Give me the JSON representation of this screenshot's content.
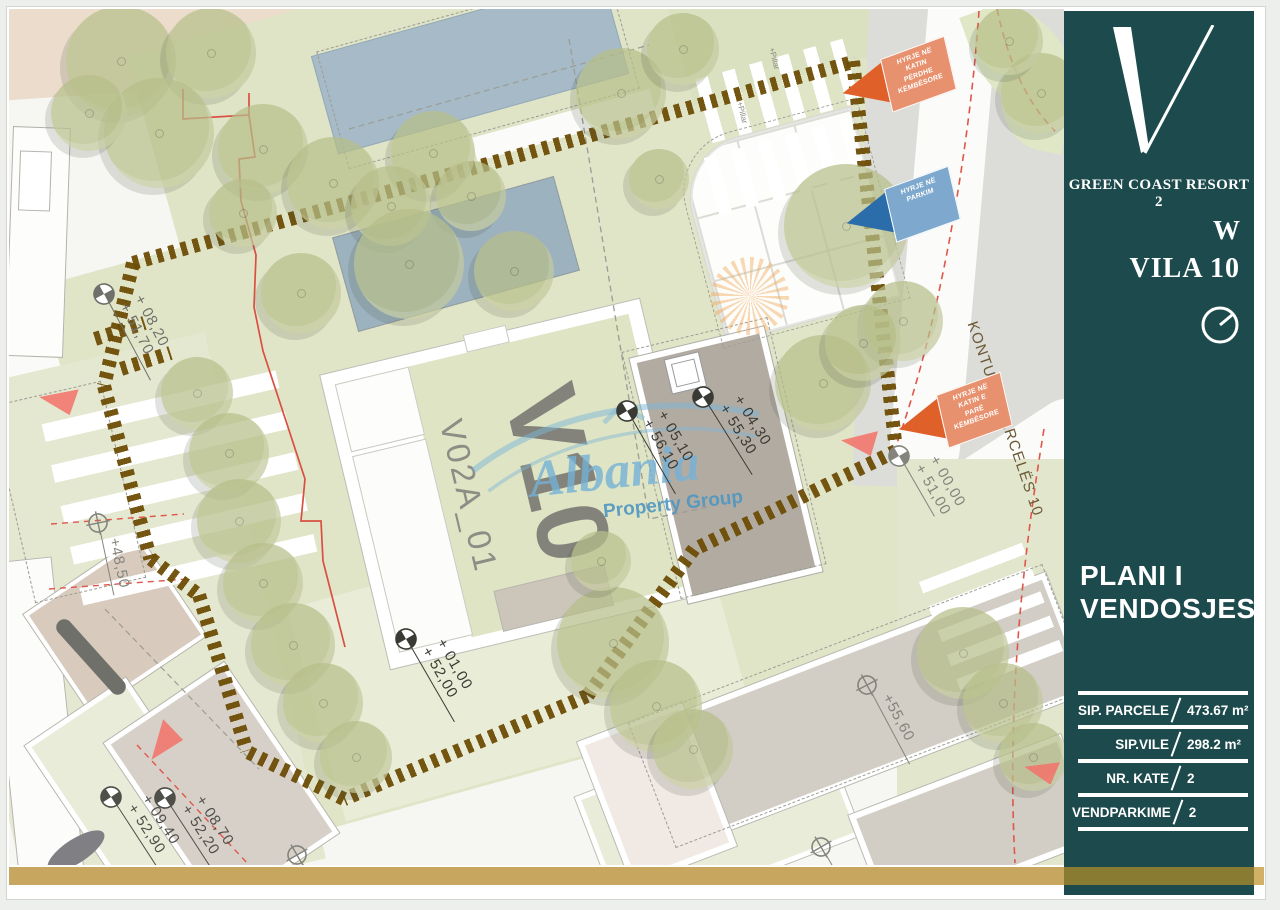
{
  "sidebar": {
    "brand": "GREEN COAST RESORT 2",
    "unit_letter": "W",
    "unit_name": "VILA 10",
    "plan_title_line1": "PLANI I",
    "plan_title_line2": "VENDOSJES",
    "table": [
      {
        "label": "SIP. PARCELE",
        "value": "473.67 m²"
      },
      {
        "label": "SIP.VILE",
        "value": "298.2  m²"
      },
      {
        "label": "NR. KATE",
        "value": "2"
      },
      {
        "label": "VENDPARKIME",
        "value": "2"
      }
    ]
  },
  "plan": {
    "villa_big_label": "V10",
    "villa_code": "V02A_01",
    "street_label": "KONTURI I PARCELËS 10",
    "pillar_label": "+Pillar",
    "watermark": {
      "line1": "Albania",
      "line2": "Property Group"
    }
  },
  "colors": {
    "sidebar_teal": "#1d4a4c",
    "gold": "#c7a65f",
    "gold_dark": "#8a7b33",
    "hatch_brown": "#6d4d06",
    "flag_orange_arrow": "#e0602a",
    "flag_orange_body": "#e8916f",
    "flag_blue_arrow": "#2b6cab",
    "flag_blue_body": "#7ea8cd",
    "red_triangle": "#f3746b",
    "watermark_blue": "#74b2d8",
    "lawn_green": "#e1e5c8",
    "pool_blue": "#a6bbc7"
  },
  "markers": [
    {
      "x": 95,
      "y": 285,
      "rot": 62,
      "type": "quad",
      "len": 88,
      "color": "#70706a",
      "lines": [
        "+ 08,20",
        "+ 51,70"
      ]
    },
    {
      "x": 89,
      "y": 514,
      "rot": 78,
      "type": "cross",
      "len": 64,
      "color": "#84847d",
      "lines": [
        "+48,50"
      ]
    },
    {
      "x": 397,
      "y": 630,
      "rot": 60,
      "type": "quad",
      "len": 86,
      "color": "#3a3a34",
      "lines": [
        "+ 01,00",
        "+ 52,00"
      ]
    },
    {
      "x": 618,
      "y": 402,
      "rot": 60,
      "type": "quad",
      "len": 86,
      "color": "#3a3a34",
      "lines": [
        "+ 05,10",
        "+ 56,10"
      ]
    },
    {
      "x": 694,
      "y": 388,
      "rot": 58,
      "type": "quad",
      "len": 82,
      "color": "#3a3a34",
      "lines": [
        "+ 04,30",
        "+ 55,30"
      ]
    },
    {
      "x": 890,
      "y": 447,
      "rot": 60,
      "type": "quad",
      "len": 60,
      "color": "#84847d",
      "lines": [
        "+ 00,00",
        "+ 51,00"
      ]
    },
    {
      "x": 858,
      "y": 676,
      "rot": 62,
      "type": "cross",
      "len": 80,
      "color": "#84847d",
      "lines": [
        "+55,60"
      ]
    },
    {
      "x": 102,
      "y": 788,
      "rot": 57,
      "type": "quad",
      "len": 85,
      "color": "#4f4f49",
      "lines": [
        "+ 09,40",
        "+ 52,90"
      ]
    },
    {
      "x": 156,
      "y": 789,
      "rot": 57,
      "type": "quad",
      "len": 85,
      "color": "#4f4f49",
      "lines": [
        "+ 08,70",
        "+ 52,20"
      ]
    },
    {
      "x": 288,
      "y": 846,
      "rot": 60,
      "type": "cross",
      "len": 26,
      "color": "#84847d",
      "lines": []
    },
    {
      "x": 812,
      "y": 838,
      "rot": 60,
      "type": "cross",
      "len": 26,
      "color": "#84847d",
      "lines": []
    }
  ],
  "flags": [
    {
      "x": 832,
      "y": 42,
      "rot": -13,
      "arrow": "#e0602a",
      "body": "#e8916f",
      "lines": [
        "HYRJE NË",
        "KATIN",
        "PËRDHE",
        "KËMBËSORE"
      ]
    },
    {
      "x": 836,
      "y": 172,
      "rot": -13,
      "arrow": "#2b6cab",
      "body": "#7ea8cd",
      "lines": [
        "HYRJE NË",
        "PARKIM"
      ]
    },
    {
      "x": 888,
      "y": 378,
      "rot": -13,
      "arrow": "#e0602a",
      "body": "#e8916f",
      "lines": [
        "HYRJE NË",
        "KATIN  E",
        "PARË",
        "KËMBËSORE"
      ]
    }
  ],
  "triangles": [
    {
      "x": 30,
      "y": 377,
      "rot": 8,
      "size": 38
    },
    {
      "x": 832,
      "y": 420,
      "rot": 5,
      "size": 36
    },
    {
      "x": 1015,
      "y": 749,
      "rot": 12,
      "size": 34
    },
    {
      "x": 134,
      "y": 720,
      "rot": -55,
      "size": 40
    }
  ],
  "trees": [
    [
      112,
      52,
      55
    ],
    [
      202,
      44,
      45
    ],
    [
      150,
      124,
      55
    ],
    [
      80,
      104,
      38
    ],
    [
      254,
      140,
      45
    ],
    [
      324,
      174,
      46
    ],
    [
      292,
      284,
      40
    ],
    [
      234,
      204,
      34
    ],
    [
      424,
      144,
      42
    ],
    [
      612,
      84,
      45
    ],
    [
      674,
      40,
      36
    ],
    [
      837,
      217,
      62
    ],
    [
      894,
      312,
      40
    ],
    [
      650,
      170,
      30
    ],
    [
      188,
      384,
      36
    ],
    [
      220,
      444,
      40
    ],
    [
      230,
      512,
      42
    ],
    [
      254,
      574,
      40
    ],
    [
      284,
      636,
      42
    ],
    [
      314,
      694,
      40
    ],
    [
      347,
      748,
      36
    ],
    [
      814,
      374,
      48
    ],
    [
      854,
      334,
      38
    ],
    [
      604,
      634,
      56
    ],
    [
      647,
      697,
      46
    ],
    [
      684,
      740,
      40
    ],
    [
      954,
      644,
      46
    ],
    [
      994,
      694,
      40
    ],
    [
      1024,
      748,
      34
    ],
    [
      1032,
      84,
      40
    ],
    [
      1000,
      32,
      34
    ],
    [
      382,
      197,
      40
    ],
    [
      462,
      187,
      35
    ],
    [
      592,
      552,
      30
    ],
    [
      400,
      255,
      55
    ],
    [
      505,
      262,
      40
    ]
  ],
  "hatch": [
    {
      "x": 124,
      "y": 254,
      "len": 750,
      "rot": -15.6
    },
    {
      "x": 844,
      "y": 52,
      "len": 395,
      "rot": 83.7
    },
    {
      "x": 887,
      "y": 442,
      "len": 225,
      "rot": 154
    },
    {
      "x": 685,
      "y": 540,
      "len": 182,
      "rot": 126
    },
    {
      "x": 578,
      "y": 687,
      "len": 264,
      "rot": 157
    },
    {
      "x": 335,
      "y": 790,
      "len": 108,
      "rot": 206
    },
    {
      "x": 190,
      "y": 586,
      "len": 163,
      "rot": 73
    },
    {
      "x": 142,
      "y": 550,
      "len": 60,
      "rot": 37
    },
    {
      "x": 95,
      "y": 377,
      "len": 179,
      "rot": 75
    },
    {
      "x": 124,
      "y": 254,
      "len": 126,
      "rot": 103.3
    },
    {
      "x": 86,
      "y": 330,
      "len": 52,
      "rot": -18
    },
    {
      "x": 112,
      "y": 360,
      "len": 52,
      "rot": -18
    }
  ]
}
